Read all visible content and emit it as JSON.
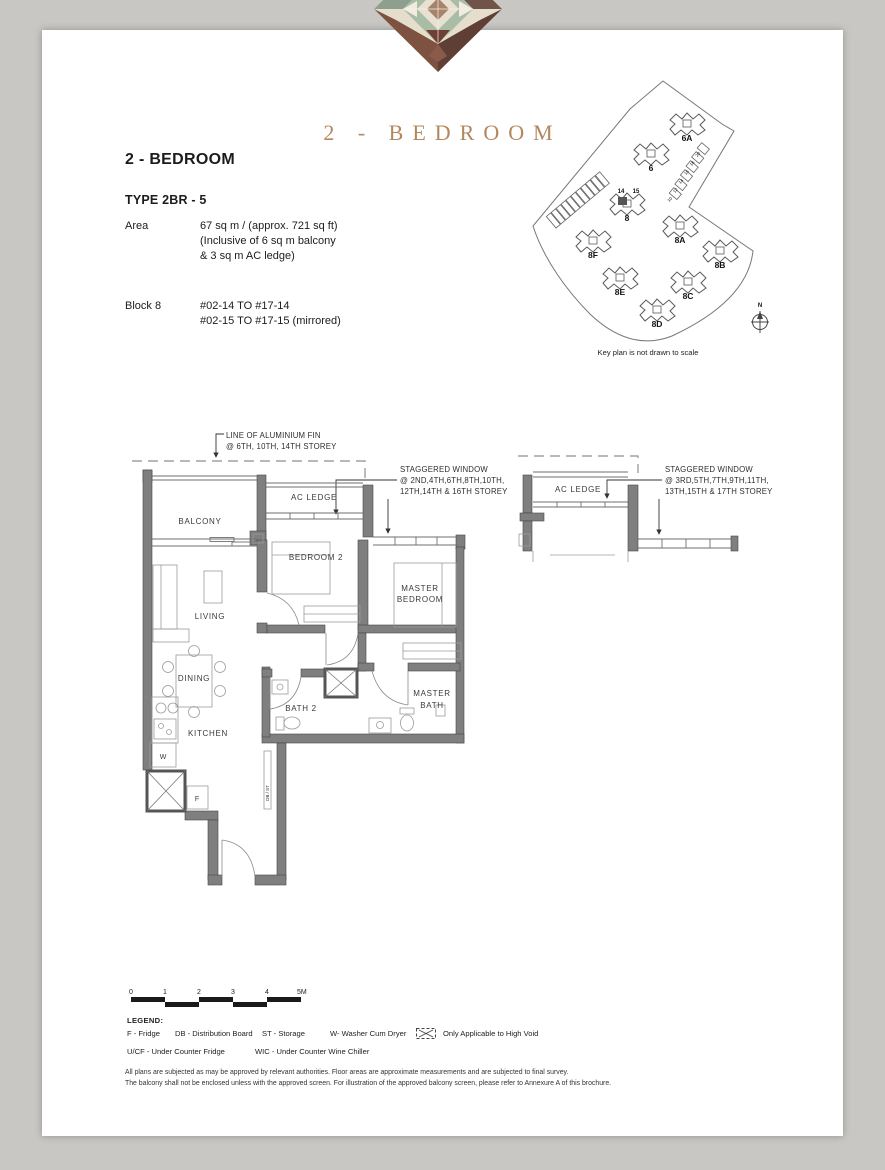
{
  "header": {
    "series_title": "2 - BEDROOM",
    "accent_color": "#b3885f"
  },
  "info": {
    "heading": "2 - BEDROOM",
    "type_label": "TYPE 2BR - 5",
    "area_label": "Area",
    "area_lines": [
      "67 sq m / (approx. 721 sq ft)",
      "(Inclusive of 6 sq m balcony",
      "& 3 sq m AC ledge)"
    ],
    "block_label": "Block 8",
    "block_lines": [
      "#02-14 TO #17-14",
      "#02-15 TO #17-15 (mirrored)"
    ]
  },
  "keyplan": {
    "caption": "Key plan is not drawn to scale",
    "north": "N",
    "unit_left": "14",
    "unit_right": "15",
    "edge_units": [
      "10",
      "12",
      "14",
      "16",
      "18",
      "20"
    ],
    "blocks": [
      {
        "label": "6A",
        "x": 157,
        "y": 63
      },
      {
        "label": "6",
        "x": 121,
        "y": 93
      },
      {
        "label": "8",
        "x": 97,
        "y": 143,
        "highlight": true
      },
      {
        "label": "8A",
        "x": 150,
        "y": 165
      },
      {
        "label": "8F",
        "x": 63,
        "y": 180
      },
      {
        "label": "8B",
        "x": 190,
        "y": 190
      },
      {
        "label": "8E",
        "x": 90,
        "y": 217
      },
      {
        "label": "8C",
        "x": 158,
        "y": 221
      },
      {
        "label": "8D",
        "x": 127,
        "y": 249
      }
    ]
  },
  "plan": {
    "fin_note": [
      "LINE OF ALUMINIUM FIN",
      "@  6TH, 10TH, 14TH STOREY"
    ],
    "staggered_a": [
      "STAGGERED WINDOW",
      "@ 2ND,4TH,6TH,8TH,10TH,",
      "12TH,14TH & 16TH STOREY"
    ],
    "staggered_b": [
      "STAGGERED WINDOW",
      "@ 3RD,5TH,7TH,9TH,11TH,",
      "13TH,15TH & 17TH STOREY"
    ],
    "rooms": {
      "balcony": "BALCONY",
      "ac_ledge": "AC LEDGE",
      "bedroom2": "BEDROOM 2",
      "master_1": "MASTER",
      "master_2": "BEDROOM",
      "living": "LIVING",
      "dining": "DINING",
      "kitchen": "KITCHEN",
      "bath2": "BATH 2",
      "mbath_1": "MASTER",
      "mbath_2": "BATH",
      "ac_ledge_b": "AC LEDGE",
      "washer": "W",
      "fridge": "F",
      "db_st": "DB / ST"
    }
  },
  "scalebar": {
    "labels": [
      "0",
      "1",
      "2",
      "3",
      "4",
      "5M"
    ]
  },
  "legend": {
    "title": "LEGEND:",
    "row1": [
      "F - Fridge",
      "DB - Distribution Board",
      "ST - Storage",
      "W- Washer Cum Dryer"
    ],
    "high_void": "Only Applicable to High Void",
    "row2": [
      "U/CF - Under Counter Fridge",
      "WIC - Under Counter Wine Chiller"
    ]
  },
  "disclaimer": {
    "line1": "All plans are subjected as may be approved by relevant authorities. Floor areas are approximate measurements and are subjected to final survey.",
    "line2": "The balcony shall not be enclosed unless with the approved screen. For illustration of the approved balcony screen, please refer to Annexure A of this brochure."
  }
}
